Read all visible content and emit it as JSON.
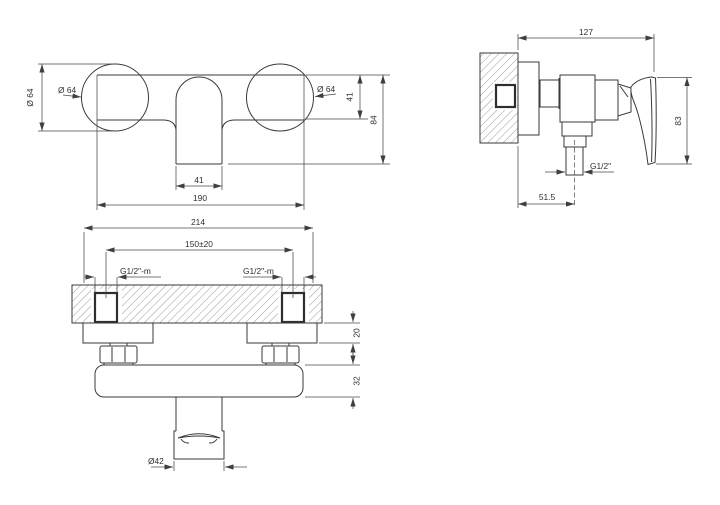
{
  "drawing": {
    "colors": {
      "line": "#3a3a3a",
      "text": "#2f2f2f",
      "background": "#ffffff"
    },
    "front_view": {
      "dim_dia_rotated": "Ø 64",
      "dim_dia_left_leader": "Ø 64",
      "dim_dia_right_leader": "Ø 64",
      "dim_body_height": "41",
      "dim_overall_height": "84",
      "dim_spout_width": "41",
      "dim_overall_width": "190"
    },
    "side_view": {
      "dim_depth": "127",
      "dim_height": "83",
      "dim_outlet_thread": "G1/2\"",
      "dim_wall_to_outlet": "51.5"
    },
    "bottom_view": {
      "dim_overall_width": "214",
      "dim_inlet_spacing": "150±20",
      "dim_inlet_thread_left": "G1/2\"-m",
      "dim_inlet_thread_right": "G1/2\"-m",
      "dim_escutcheon_depth": "20",
      "dim_body_depth": "32",
      "dim_outlet_diameter": "Ø42"
    }
  }
}
